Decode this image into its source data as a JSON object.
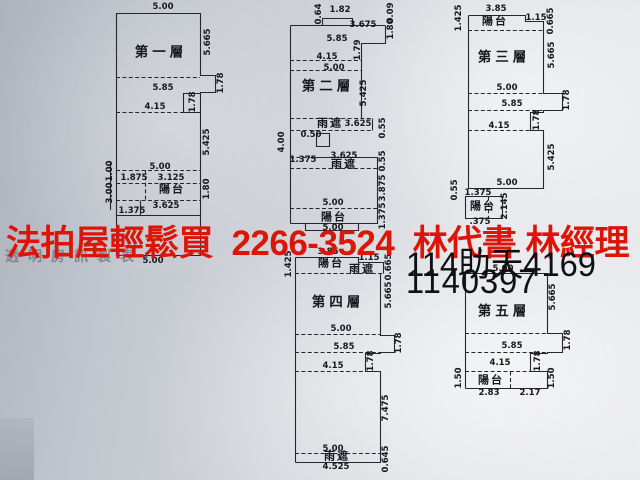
{
  "banner": {
    "text": "法拍屋輕鬆買  2266-3524  林代書 林經理",
    "color": "#dd1508"
  },
  "watermark": {
    "text": "透明房訊製表",
    "color": "#787c86"
  },
  "case_numbers": {
    "line1": "114助天4169",
    "line2": "1140397",
    "color": "#101014"
  },
  "floor_plans": [
    {
      "name": "第一層",
      "name_pos": {
        "x": 161,
        "y": 52
      },
      "rooms": [
        {
          "t": "陽台",
          "x": 172,
          "y": 190
        }
      ],
      "dims": [
        {
          "t": "5.00",
          "x": 163,
          "y": 7
        },
        {
          "t": "5.665",
          "x": 208,
          "y": 42,
          "v": 1
        },
        {
          "t": "1.78",
          "x": 221,
          "y": 83,
          "v": 1
        },
        {
          "t": "5.85",
          "x": 163,
          "y": 88
        },
        {
          "t": "1.78",
          "x": 193,
          "y": 102,
          "v": 1
        },
        {
          "t": "4.15",
          "x": 155,
          "y": 107
        },
        {
          "t": "5.425",
          "x": 207,
          "y": 142,
          "v": 1
        },
        {
          "t": "5.00",
          "x": 160,
          "y": 167
        },
        {
          "t": "1.00",
          "x": 110,
          "y": 171,
          "v": 1
        },
        {
          "t": "1.875",
          "x": 134,
          "y": 178
        },
        {
          "t": "3.125",
          "x": 171,
          "y": 178
        },
        {
          "t": "1.80",
          "x": 207,
          "y": 189,
          "v": 1
        },
        {
          "t": "3.00",
          "x": 110,
          "y": 193,
          "v": 1
        },
        {
          "t": "3.625",
          "x": 166,
          "y": 206
        },
        {
          "t": "1.375",
          "x": 132,
          "y": 211
        },
        {
          "t": "5.00",
          "x": 153,
          "y": 261
        }
      ]
    },
    {
      "name": "第二層",
      "name_pos": {
        "x": 328,
        "y": 86
      },
      "rooms": [
        {
          "t": "雨遮",
          "x": 330,
          "y": 124
        },
        {
          "t": "雨遮",
          "x": 344,
          "y": 165
        },
        {
          "t": "陽台",
          "x": 334,
          "y": 218
        }
      ],
      "dims": [
        {
          "t": "0.64",
          "x": 319,
          "y": 14,
          "v": 1
        },
        {
          "t": "1.82",
          "x": 340,
          "y": 10
        },
        {
          "t": "3.675",
          "x": 363,
          "y": 25
        },
        {
          "t": "0.09",
          "x": 391,
          "y": 13,
          "v": 1
        },
        {
          "t": "1.80",
          "x": 391,
          "y": 29,
          "v": 1
        },
        {
          "t": "5.85",
          "x": 337,
          "y": 39
        },
        {
          "t": "1.79",
          "x": 358,
          "y": 50,
          "v": 1
        },
        {
          "t": "4.15",
          "x": 327,
          "y": 57
        },
        {
          "t": "5.00",
          "x": 334,
          "y": 68
        },
        {
          "t": "5.425",
          "x": 364,
          "y": 93,
          "v": 1
        },
        {
          "t": "3.625",
          "x": 358,
          "y": 124
        },
        {
          "t": "0.55",
          "x": 383,
          "y": 128,
          "v": 1
        },
        {
          "t": "0.50",
          "x": 311,
          "y": 135
        },
        {
          "t": "4.00",
          "x": 282,
          "y": 142,
          "v": 1
        },
        {
          "t": "1.375",
          "x": 303,
          "y": 160
        },
        {
          "t": "3.625",
          "x": 344,
          "y": 156
        },
        {
          "t": "0.55",
          "x": 383,
          "y": 161,
          "v": 1
        },
        {
          "t": "3.875",
          "x": 383,
          "y": 188,
          "v": 1
        },
        {
          "t": "5.00",
          "x": 333,
          "y": 203
        },
        {
          "t": "1.375",
          "x": 383,
          "y": 216,
          "v": 1
        },
        {
          "t": "5.00",
          "x": 333,
          "y": 228
        }
      ]
    },
    {
      "name": "第三層",
      "name_pos": {
        "x": 504,
        "y": 57
      },
      "rooms": [
        {
          "t": "陽台",
          "x": 495,
          "y": 22
        },
        {
          "t": "陽台",
          "x": 483,
          "y": 207
        }
      ],
      "dims": [
        {
          "t": "3.85",
          "x": 496,
          "y": 9
        },
        {
          "t": "1.425",
          "x": 459,
          "y": 18,
          "v": 1
        },
        {
          "t": "1.15",
          "x": 536,
          "y": 18
        },
        {
          "t": "0.665",
          "x": 551,
          "y": 21,
          "v": 1
        },
        {
          "t": "5.665",
          "x": 552,
          "y": 55,
          "v": 1
        },
        {
          "t": "5.00",
          "x": 507,
          "y": 88
        },
        {
          "t": "1.78",
          "x": 567,
          "y": 100,
          "v": 1
        },
        {
          "t": "5.85",
          "x": 512,
          "y": 104
        },
        {
          "t": "1.78",
          "x": 537,
          "y": 120,
          "v": 1
        },
        {
          "t": "4.15",
          "x": 499,
          "y": 126
        },
        {
          "t": "5.425",
          "x": 552,
          "y": 157,
          "v": 1
        },
        {
          "t": "5.00",
          "x": 507,
          "y": 183
        },
        {
          "t": "0.55",
          "x": 455,
          "y": 190,
          "v": 1
        },
        {
          "t": "1.375",
          "x": 478,
          "y": 193
        },
        {
          "t": "2.145",
          "x": 505,
          "y": 206,
          "v": 1
        },
        {
          "t": ".375",
          "x": 480,
          "y": 222
        }
      ]
    },
    {
      "name": "第四層",
      "name_pos": {
        "x": 338,
        "y": 302
      },
      "rooms": [
        {
          "t": "陽台",
          "x": 331,
          "y": 264
        },
        {
          "t": "雨遮",
          "x": 362,
          "y": 270
        },
        {
          "t": "雨遮",
          "x": 337,
          "y": 457
        }
      ],
      "dims": [
        {
          "t": "3.85",
          "x": 328,
          "y": 252
        },
        {
          "t": "1.425",
          "x": 289,
          "y": 264,
          "v": 1
        },
        {
          "t": "1.15",
          "x": 369,
          "y": 258
        },
        {
          "t": "0.665",
          "x": 389,
          "y": 267,
          "v": 1
        },
        {
          "t": "5.665",
          "x": 389,
          "y": 295,
          "v": 1
        },
        {
          "t": "5.00",
          "x": 341,
          "y": 329
        },
        {
          "t": "1.78",
          "x": 399,
          "y": 343,
          "v": 1
        },
        {
          "t": "5.85",
          "x": 344,
          "y": 347
        },
        {
          "t": "1.78",
          "x": 371,
          "y": 361,
          "v": 1
        },
        {
          "t": "4.15",
          "x": 333,
          "y": 366
        },
        {
          "t": "7.475",
          "x": 386,
          "y": 408,
          "v": 1
        },
        {
          "t": "5.00",
          "x": 333,
          "y": 449
        },
        {
          "t": "4.525",
          "x": 336,
          "y": 467
        },
        {
          "t": "0.645",
          "x": 386,
          "y": 459,
          "v": 1
        }
      ]
    },
    {
      "name": "第五層",
      "name_pos": {
        "x": 504,
        "y": 311
      },
      "rooms": [
        {
          "t": "陽台",
          "x": 491,
          "y": 381
        }
      ],
      "dims": [
        {
          "t": "5.00",
          "x": 503,
          "y": 269
        },
        {
          "t": "5.665",
          "x": 553,
          "y": 297,
          "v": 1
        },
        {
          "t": "1.78",
          "x": 568,
          "y": 340,
          "v": 1
        },
        {
          "t": "5.85",
          "x": 512,
          "y": 346
        },
        {
          "t": "1.78",
          "x": 538,
          "y": 361,
          "v": 1
        },
        {
          "t": "4.15",
          "x": 500,
          "y": 363
        },
        {
          "t": "1.50",
          "x": 459,
          "y": 378,
          "v": 1
        },
        {
          "t": "1.50",
          "x": 552,
          "y": 378,
          "v": 1
        },
        {
          "t": "2.83",
          "x": 489,
          "y": 393
        },
        {
          "t": "2.17",
          "x": 530,
          "y": 393
        }
      ]
    }
  ]
}
